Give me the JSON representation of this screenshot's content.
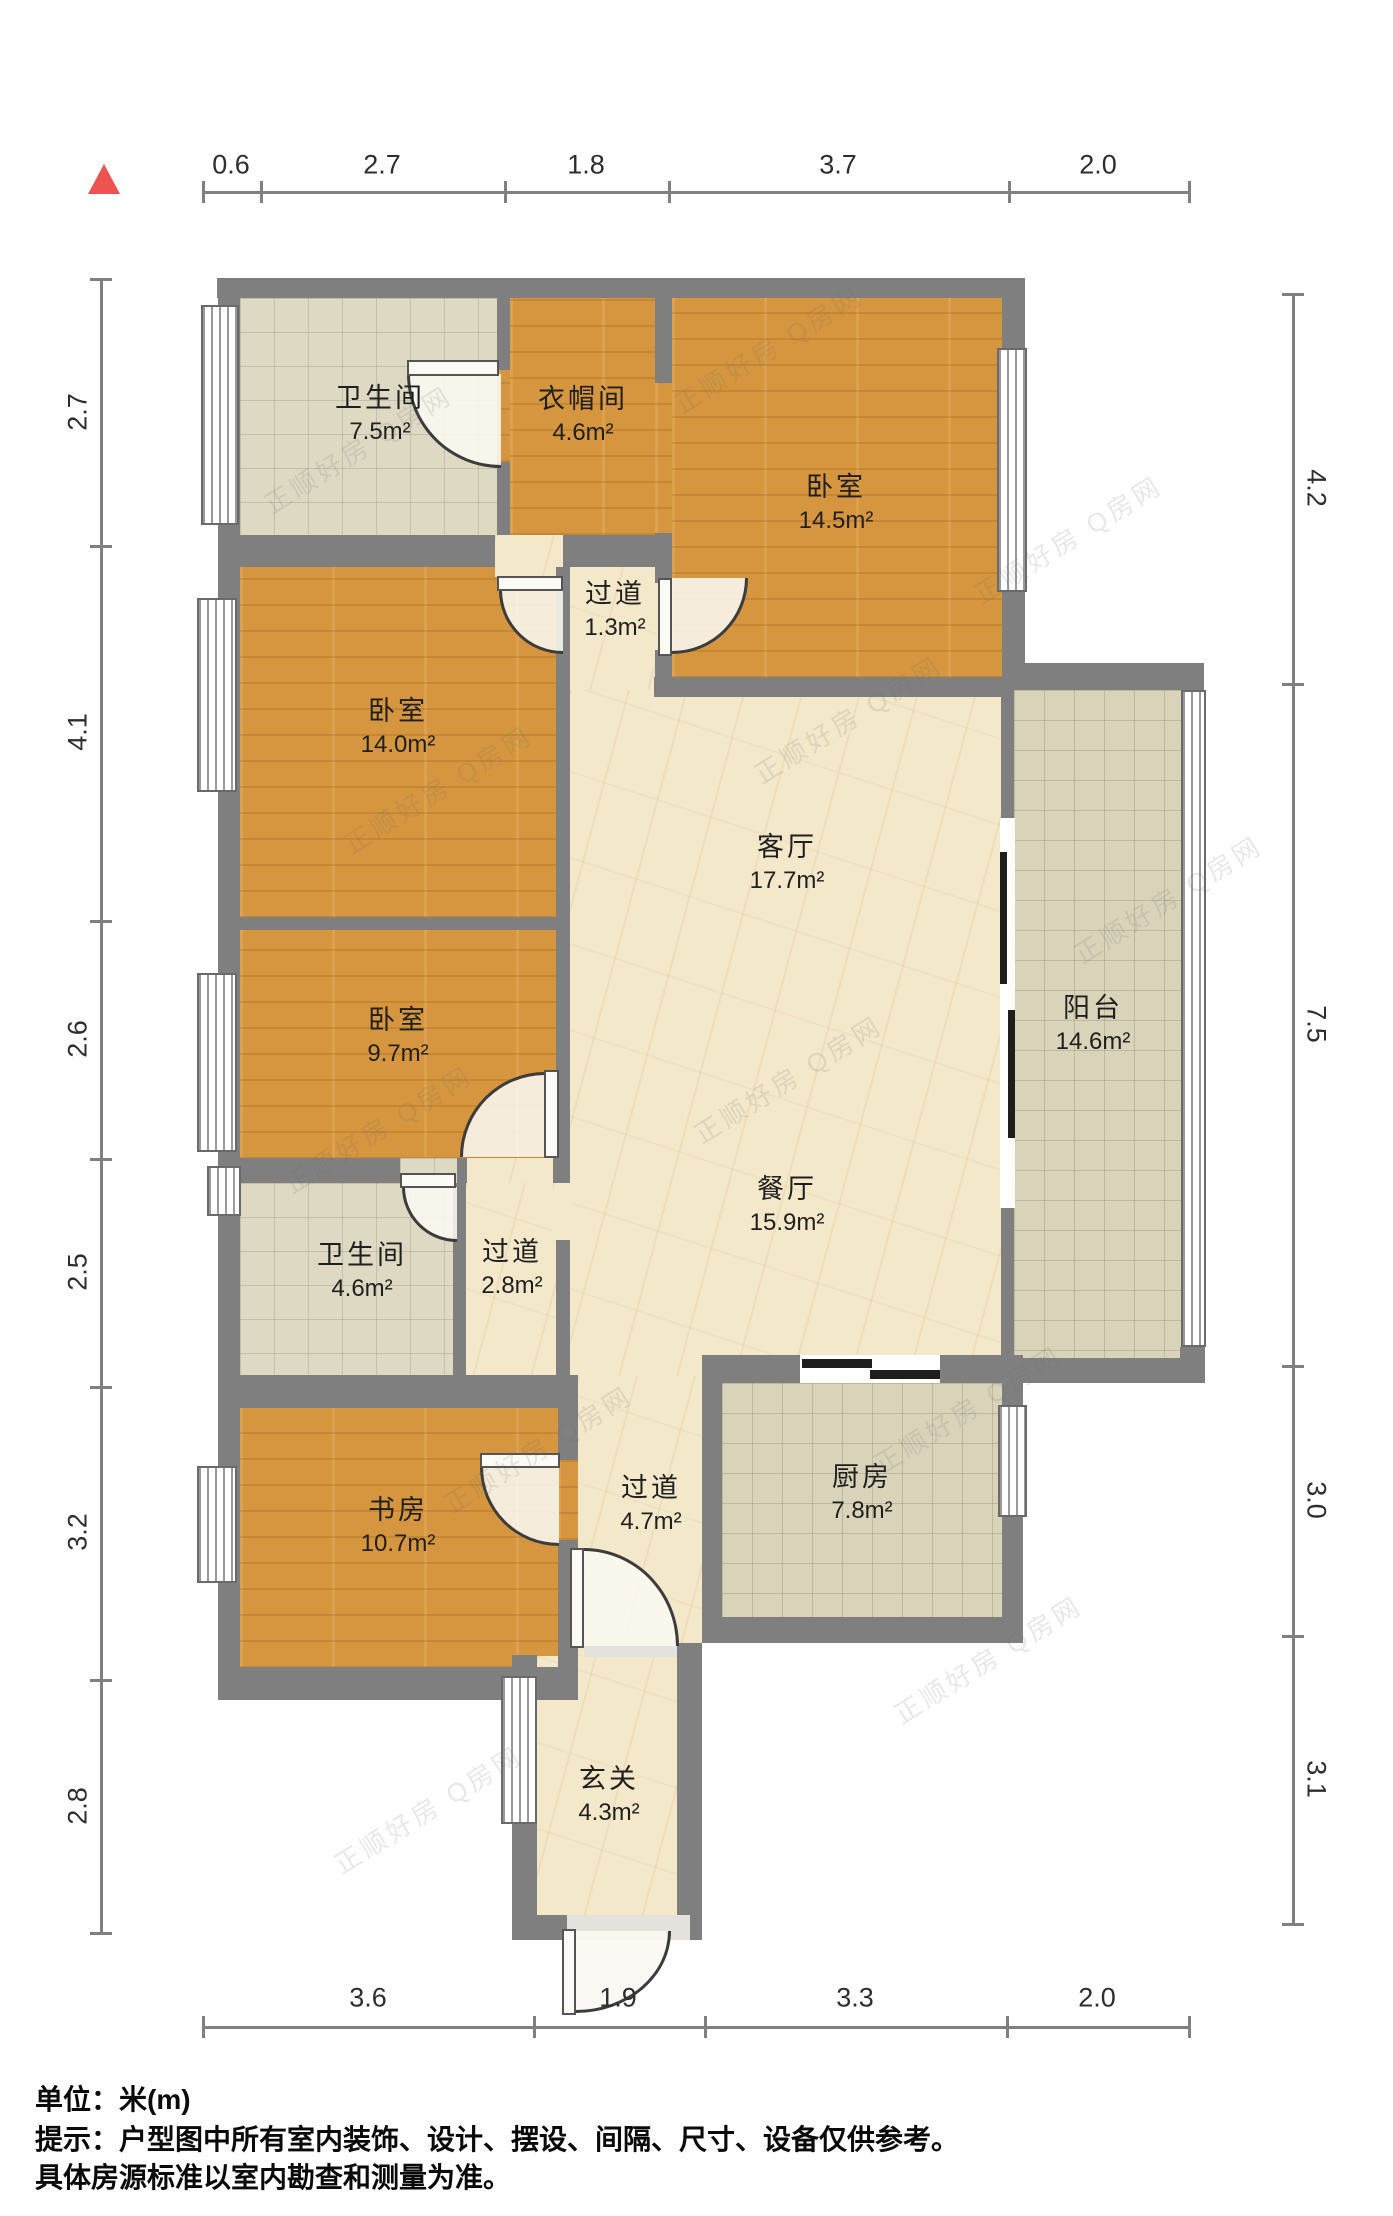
{
  "plan": {
    "unit_scale_note": "米(m)",
    "north_marker": "red-triangle"
  },
  "rooms": [
    {
      "name": "卫生间",
      "area": "7.5m²"
    },
    {
      "name": "衣帽间",
      "area": "4.6m²"
    },
    {
      "name": "卧室",
      "area": "14.5m²"
    },
    {
      "name": "过道",
      "area": "1.3m²"
    },
    {
      "name": "卧室",
      "area": "14.0m²"
    },
    {
      "name": "客厅",
      "area": "17.7m²"
    },
    {
      "name": "阳台",
      "area": "14.6m²"
    },
    {
      "name": "卧室",
      "area": "9.7m²"
    },
    {
      "name": "餐厅",
      "area": "15.9m²"
    },
    {
      "name": "卫生间",
      "area": "4.6m²"
    },
    {
      "name": "过道",
      "area": "2.8m²"
    },
    {
      "name": "书房",
      "area": "10.7m²"
    },
    {
      "name": "过道",
      "area": "4.7m²"
    },
    {
      "name": "厨房",
      "area": "7.8m²"
    },
    {
      "name": "玄关",
      "area": "4.3m²"
    }
  ],
  "dims": {
    "top": [
      "0.6",
      "2.7",
      "1.8",
      "3.7",
      "2.0"
    ],
    "bottom": [
      "3.6",
      "1.9",
      "3.3",
      "2.0"
    ],
    "left": [
      "2.7",
      "4.1",
      "2.6",
      "2.5",
      "3.2",
      "2.8"
    ],
    "right": [
      "4.2",
      "7.5",
      "3.0",
      "3.1"
    ]
  },
  "notes": {
    "unit_label": "单位：米(m)",
    "tip_line1": "提示：户型图中所有室内装饰、设计、摆设、间隔、尺寸、设备仅供参考。",
    "tip_line2": "具体房源标准以室内勘查和测量为准。"
  },
  "watermark": {
    "text": "正顺好房 Q房网"
  },
  "colors": {
    "wall": "#7f7f7f",
    "wood_floor": "#d6963f",
    "marble_floor": "#f4e8cb",
    "tile_floor": "#ded9c3",
    "balcony_tile": "#d8d3b9",
    "north_marker": "#ef5350",
    "dim_line": "#808080"
  }
}
